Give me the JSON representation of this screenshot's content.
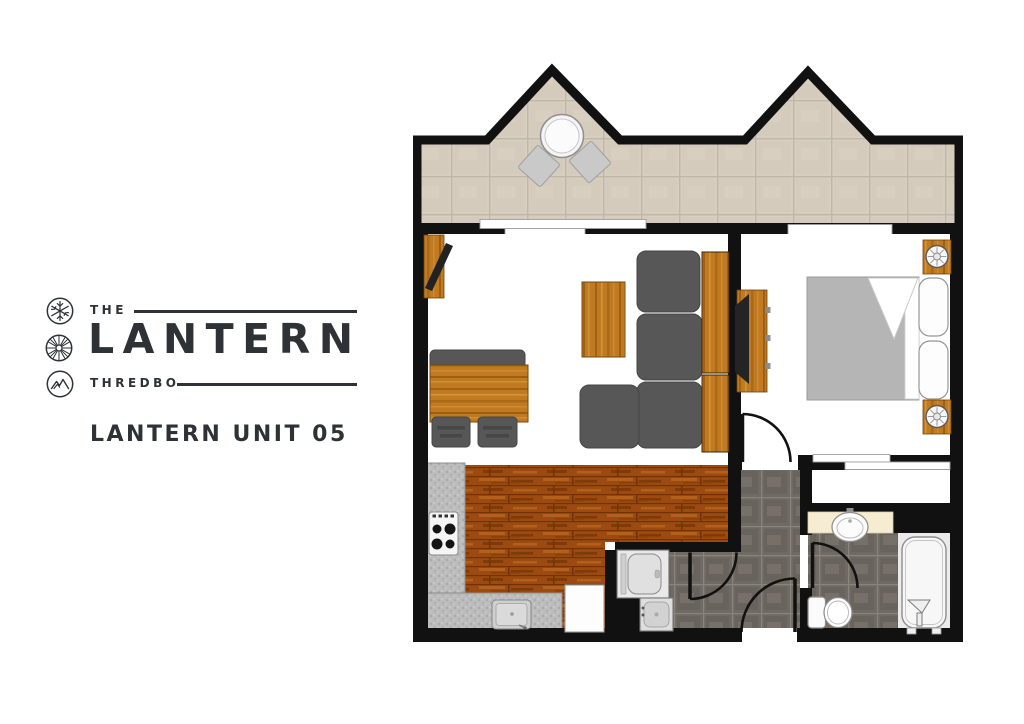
{
  "branding": {
    "brand_prefix": "THE",
    "brand_name": "LANTERN",
    "brand_location": "THREDBO",
    "unit_label": "LANTERN UNIT 05",
    "icons": [
      "snowflake-icon",
      "wheel-icon",
      "mountain-icon"
    ],
    "text_color": "#2e3236"
  },
  "floor_plan": {
    "type": "apartment-floor-plan",
    "rooms": [
      {
        "name": "balcony",
        "floor": "beige-tile",
        "furniture": [
          "outdoor-round-table",
          "outdoor-chair",
          "outdoor-chair"
        ]
      },
      {
        "name": "living-dining",
        "floor": "white",
        "furniture": [
          "tv-cabinet",
          "dining-bench",
          "dining-table",
          "dining-chair",
          "dining-chair",
          "coffee-table",
          "corner-sofa",
          "sideboard"
        ]
      },
      {
        "name": "bedroom",
        "floor": "white",
        "furniture": [
          "wall-tv-panel",
          "double-bed",
          "pillow",
          "pillow",
          "nightstand-with-lamp",
          "nightstand-with-lamp"
        ]
      },
      {
        "name": "kitchen",
        "floor": "timber",
        "furniture": [
          "cooktop",
          "kitchen-sink",
          "fridge",
          "l-shaped-bench"
        ]
      },
      {
        "name": "laundry",
        "floor": "dark-tile",
        "furniture": [
          "washing-machine",
          "laundry-tub"
        ]
      },
      {
        "name": "entry-hall",
        "floor": "dark-tile",
        "furniture": [
          "entry-door"
        ]
      },
      {
        "name": "bathroom",
        "floor": "dark-tile",
        "furniture": [
          "vanity-basin",
          "toilet",
          "bathtub"
        ]
      }
    ],
    "colors": {
      "wall": "#111111",
      "deck_tile": "#d6cec0",
      "timber_floor": "#9c4a10",
      "wood_furniture": "#c07b22",
      "sofa_gray": "#575757",
      "dark_tile": "#6f6a64",
      "counter_gray": "#bcbcbc",
      "vanity_cream": "#f6ecd2",
      "bed_gray": "#b5b5b5"
    }
  }
}
